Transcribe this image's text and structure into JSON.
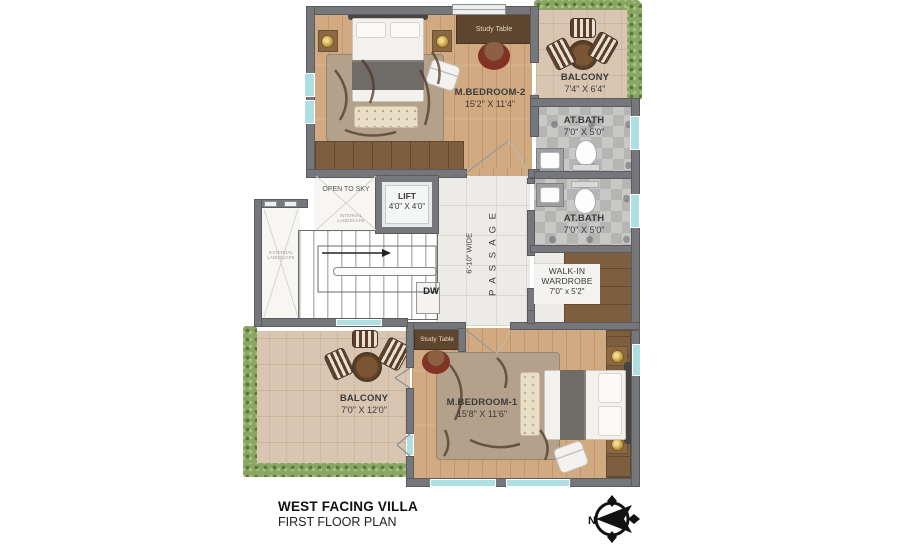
{
  "title": {
    "building": "WEST FACING VILLA",
    "plan": "FIRST FLOOR PLAN"
  },
  "compass": {
    "north_label": "N"
  },
  "palette": {
    "wall": "#75777a",
    "wood_floor": "#d1aa82",
    "balcony_tile": "#d9c6b2",
    "bath_tile": "#bdbdbc",
    "hedge_green": "#8ba567",
    "wardrobe_brown": "#7d5e3f",
    "window_glass": "#aedfe2",
    "accent_red_chair": "#7c3527"
  },
  "rooms": {
    "m_bedroom_2": {
      "name": "M.BEDROOM-2",
      "dims": "15'2\" X 11'4\""
    },
    "balcony_top": {
      "name": "BALCONY",
      "dims": "7'4\" X 6'4\""
    },
    "at_bath_1": {
      "name": "AT.BATH",
      "dims": "7'0\" X 5'0\""
    },
    "at_bath_2": {
      "name": "AT.BATH",
      "dims": "7'0\" X 5'0\""
    },
    "walk_in_wardrobe": {
      "line1": "WALK-IN",
      "line2": "WARDROBE",
      "dims": "7'0\" x 5'2\""
    },
    "lift": {
      "name": "LIFT",
      "dims": "4'0\" X 4'0\""
    },
    "passage": {
      "name": "P A S S A G E",
      "width_note": "6'-10\" WIDE"
    },
    "open_to_sky": {
      "name": "OPEN TO SKY"
    },
    "internal_landscape": {
      "line1": "INTERNAL",
      "line2": "LANDSCAPE"
    },
    "external_landscape": {
      "line1": "EXTERNAL",
      "line2": "LANDSCAPE"
    },
    "balcony_bottom": {
      "name": "BALCONY",
      "dims": "7'0\" X 12'0\""
    },
    "m_bedroom_1": {
      "name": "M.BEDROOM-1",
      "dims": "15'8\" X 11'6\""
    }
  },
  "labels": {
    "study_table_top": "Study Table",
    "study_table_bottom": "Study Table",
    "dw": "DW"
  }
}
